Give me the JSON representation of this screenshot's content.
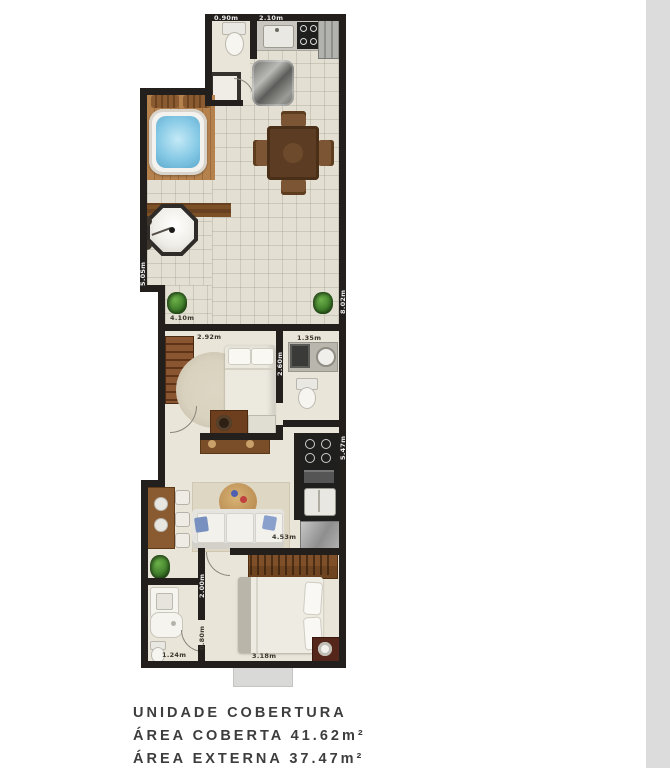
{
  "caption": {
    "line1": "UNIDADE COBERTURA",
    "line2": "ÁREA COBERTA 41.62m²",
    "line3": "ÁREA EXTERNA 37.47m²"
  },
  "labels": {
    "d090": "0.90m",
    "d210": "2.10m",
    "d505": "5.05m",
    "d802": "8.02m",
    "d410": "4.10m",
    "d292": "2.92m",
    "d260": "2.60m",
    "d135": "1.35m",
    "d547": "5.47m",
    "d453": "4.53m",
    "d200": "2.00m",
    "d080": "0.80m",
    "d124": "1.24m",
    "d318": "3.18m"
  },
  "colors": {
    "wall": "#221f1c",
    "terrace_floor": "#e3dfd3",
    "interior_floor": "#eae5d9",
    "water_blue": "#82c7e4",
    "wood_deck": "#ab7a4a",
    "furniture_brown": "#7a4f2c",
    "appliance_dark": "#1f1f1e",
    "fridge_gray": "#aaaaaa",
    "plant_green": "#3f7d2a",
    "rug": "#d9d2bf",
    "label_dark": "#3a352c",
    "label_light": "#eeeeee",
    "caption_text": "#3d3d3d",
    "edge_strip": "#dcdcdc"
  }
}
